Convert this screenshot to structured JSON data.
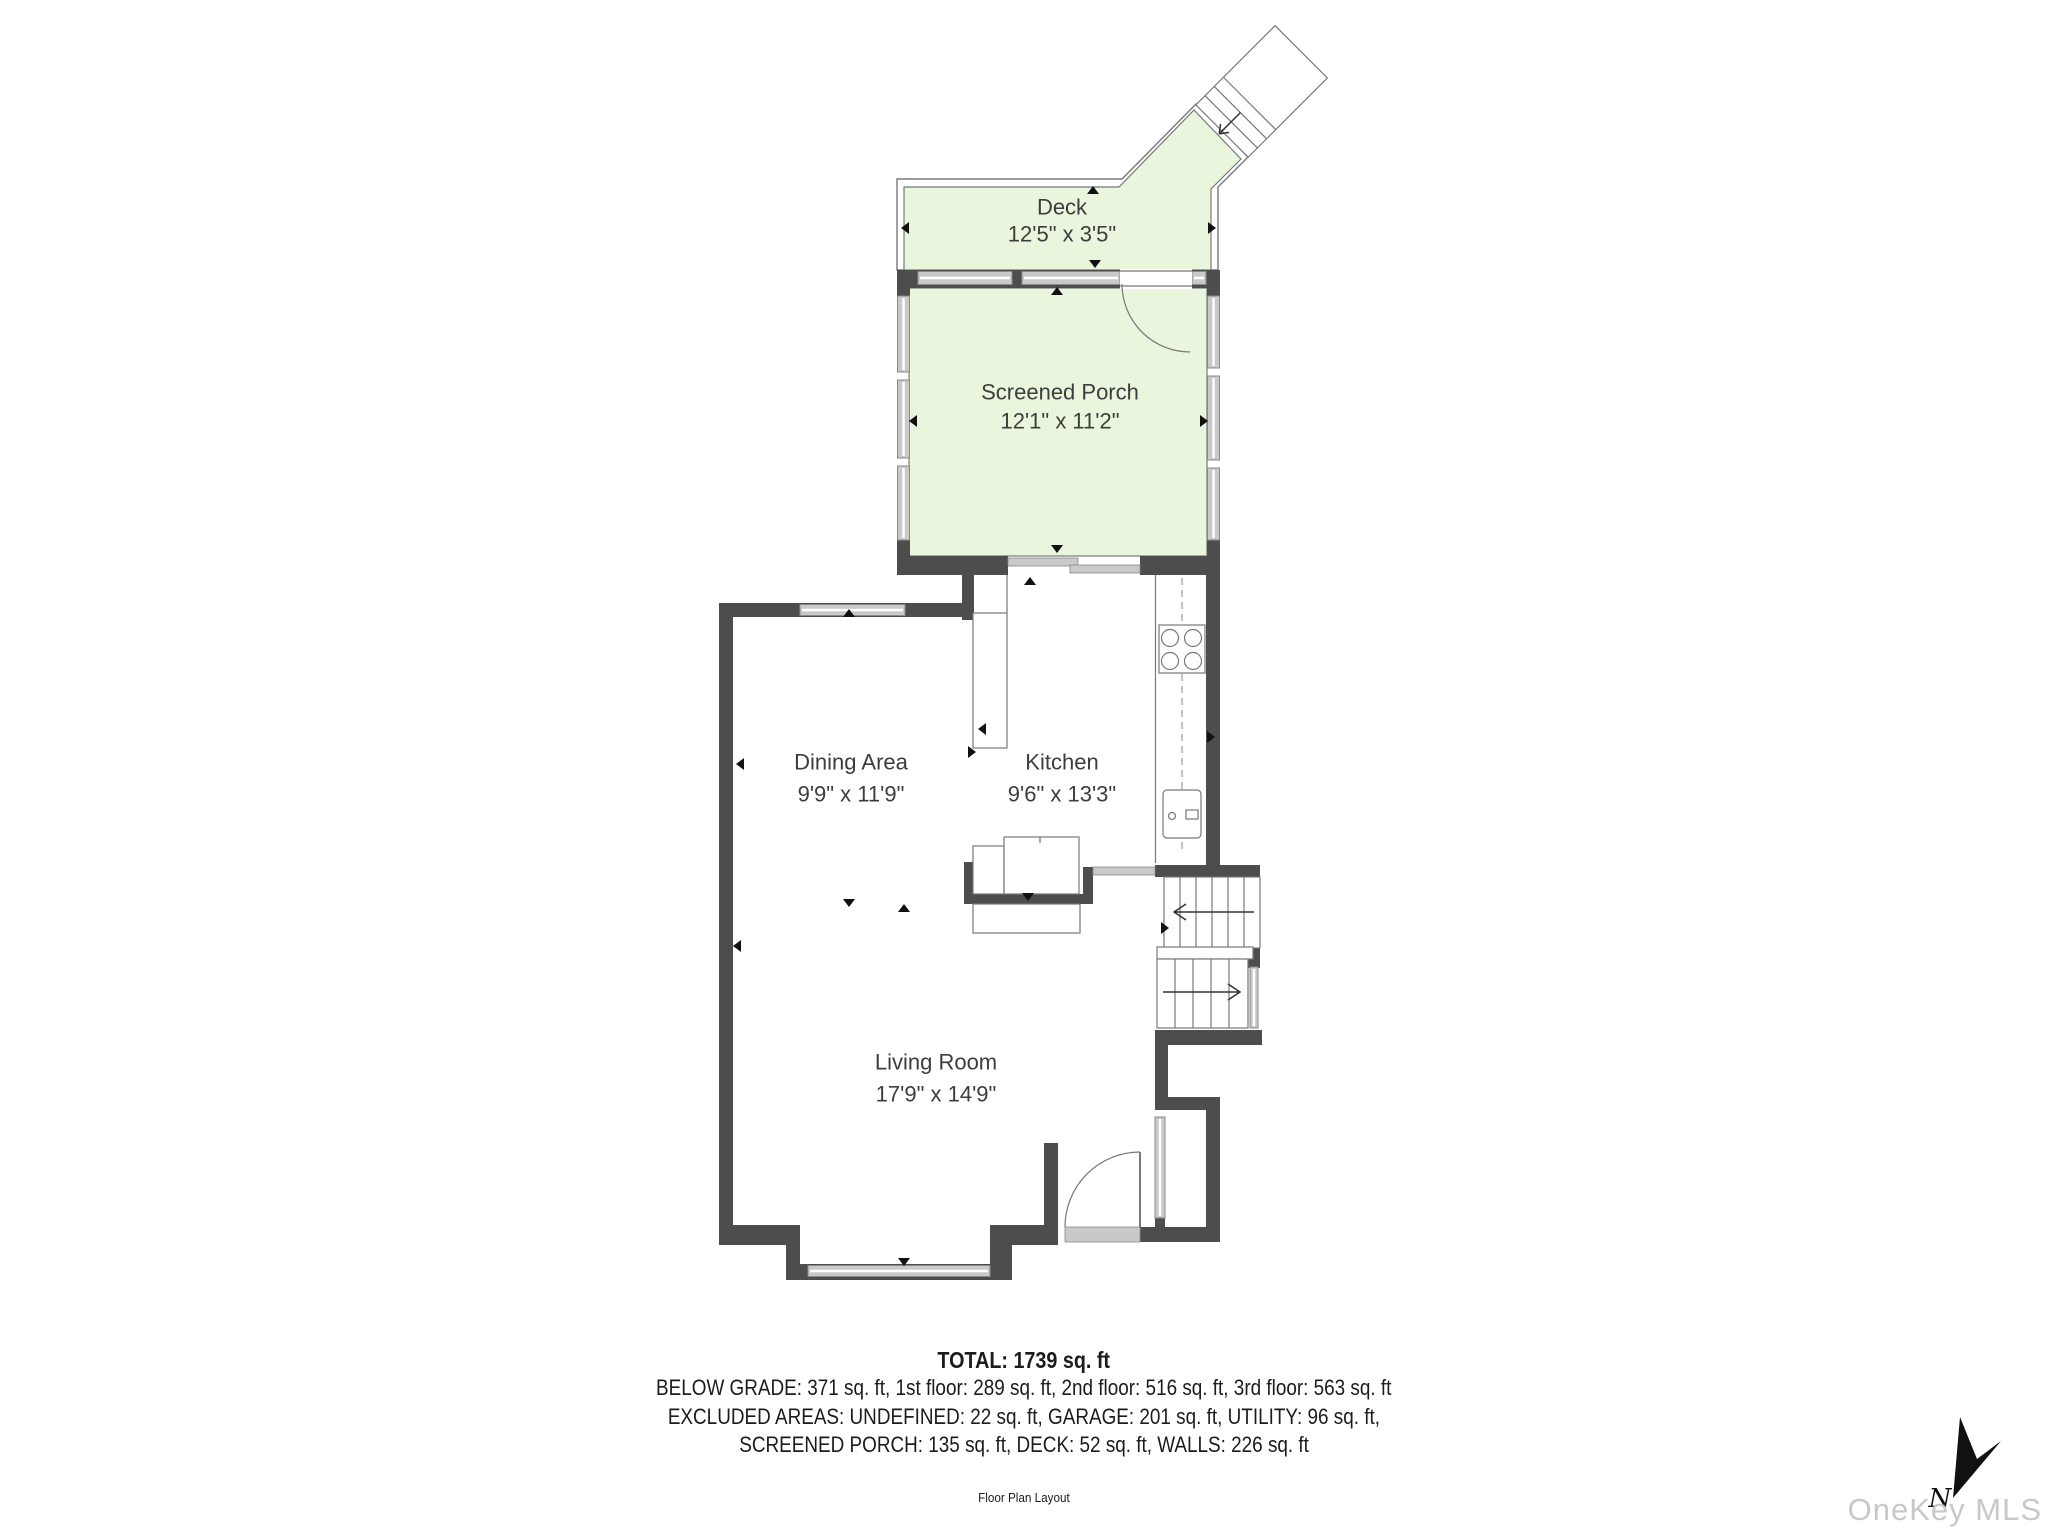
{
  "plan": {
    "rooms": [
      {
        "id": "deck",
        "name": "Deck",
        "dims": "12'5\" x 3'5\""
      },
      {
        "id": "screened_porch",
        "name": "Screened Porch",
        "dims": "12'1\" x 11'2\""
      },
      {
        "id": "dining_area",
        "name": "Dining Area",
        "dims": "9'9\" x 11'9\""
      },
      {
        "id": "kitchen",
        "name": "Kitchen",
        "dims": "9'6\" x 13'3\""
      },
      {
        "id": "living_room",
        "name": "Living Room",
        "dims": "17'9\" x 14'9\""
      }
    ]
  },
  "summary": {
    "total": "TOTAL: 1739 sq. ft",
    "line1": "BELOW GRADE: 371 sq. ft, 1st floor: 289 sq. ft, 2nd floor: 516 sq. ft, 3rd floor: 563 sq. ft",
    "line2": "EXCLUDED AREAS: UNDEFINED: 22 sq. ft, GARAGE: 201 sq. ft, UTILITY: 96 sq. ft,",
    "line3": "SCREENED PORCH: 135 sq. ft, DECK: 52 sq. ft, WALLS: 226 sq. ft",
    "caption": "Floor Plan Layout"
  },
  "compass": {
    "label": "N"
  },
  "watermark": {
    "text": "OneKey MLS"
  },
  "colors": {
    "wall": "#4d4d4d",
    "window_fill": "#c9c9c9",
    "window_border": "#8a8a8a",
    "porch_fill": "#e9f6dd",
    "outline": "#787878",
    "label_text": "#3d3d3d",
    "summary_text": "#1c1c1c",
    "watermark_text": "#c8c8c8",
    "marker": "#111111"
  }
}
